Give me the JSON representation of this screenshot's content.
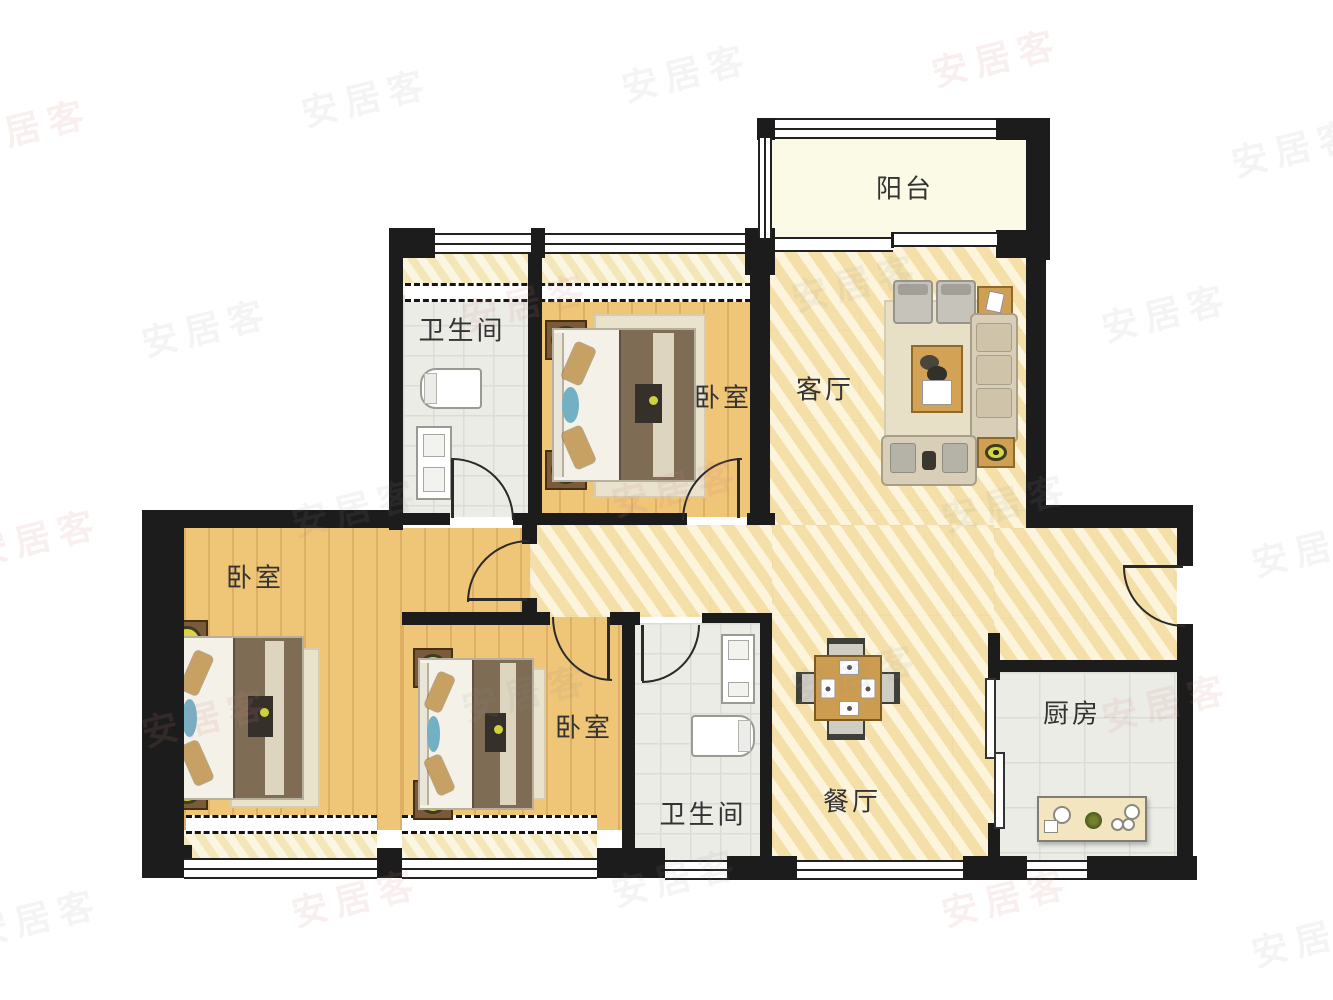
{
  "watermark": {
    "text": "安居客"
  },
  "colors": {
    "wall": "#1c1c1c",
    "wood_floor": "#efc578",
    "marble_floor": "#f6e7b6",
    "tile_floor": "#ecece7",
    "balcony_floor": "#fbfae6",
    "lamp_accent": "#d9d441",
    "furniture_wood": "#cc9c50",
    "watermark_tint": "#cd8282"
  },
  "rooms": {
    "balcony": {
      "label": "阳台"
    },
    "bathroom_top": {
      "label": "卫生间"
    },
    "bedroom_top": {
      "label": "卧室"
    },
    "living_room": {
      "label": "客厅"
    },
    "bedroom_left": {
      "label": "卧室"
    },
    "bedroom_middle": {
      "label": "卧室"
    },
    "bathroom_bottom": {
      "label": "卫生间"
    },
    "dining_room": {
      "label": "餐厅"
    },
    "kitchen": {
      "label": "厨房"
    }
  }
}
